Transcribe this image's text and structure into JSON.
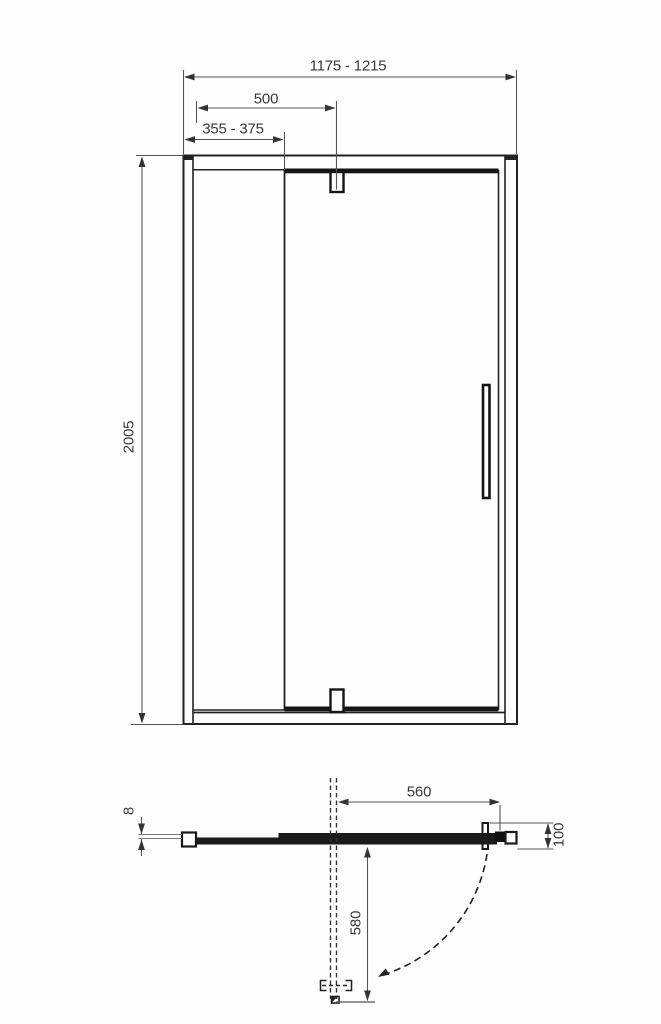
{
  "front_view": {
    "overall_width_range": "1175 - 1215",
    "pivot_offset": "500",
    "fixed_panel_range": "355 - 375",
    "height": "2005"
  },
  "plan_view": {
    "glass_thickness": "8",
    "door_width": "560",
    "profile_depth": "100",
    "swing_depth": "580"
  }
}
